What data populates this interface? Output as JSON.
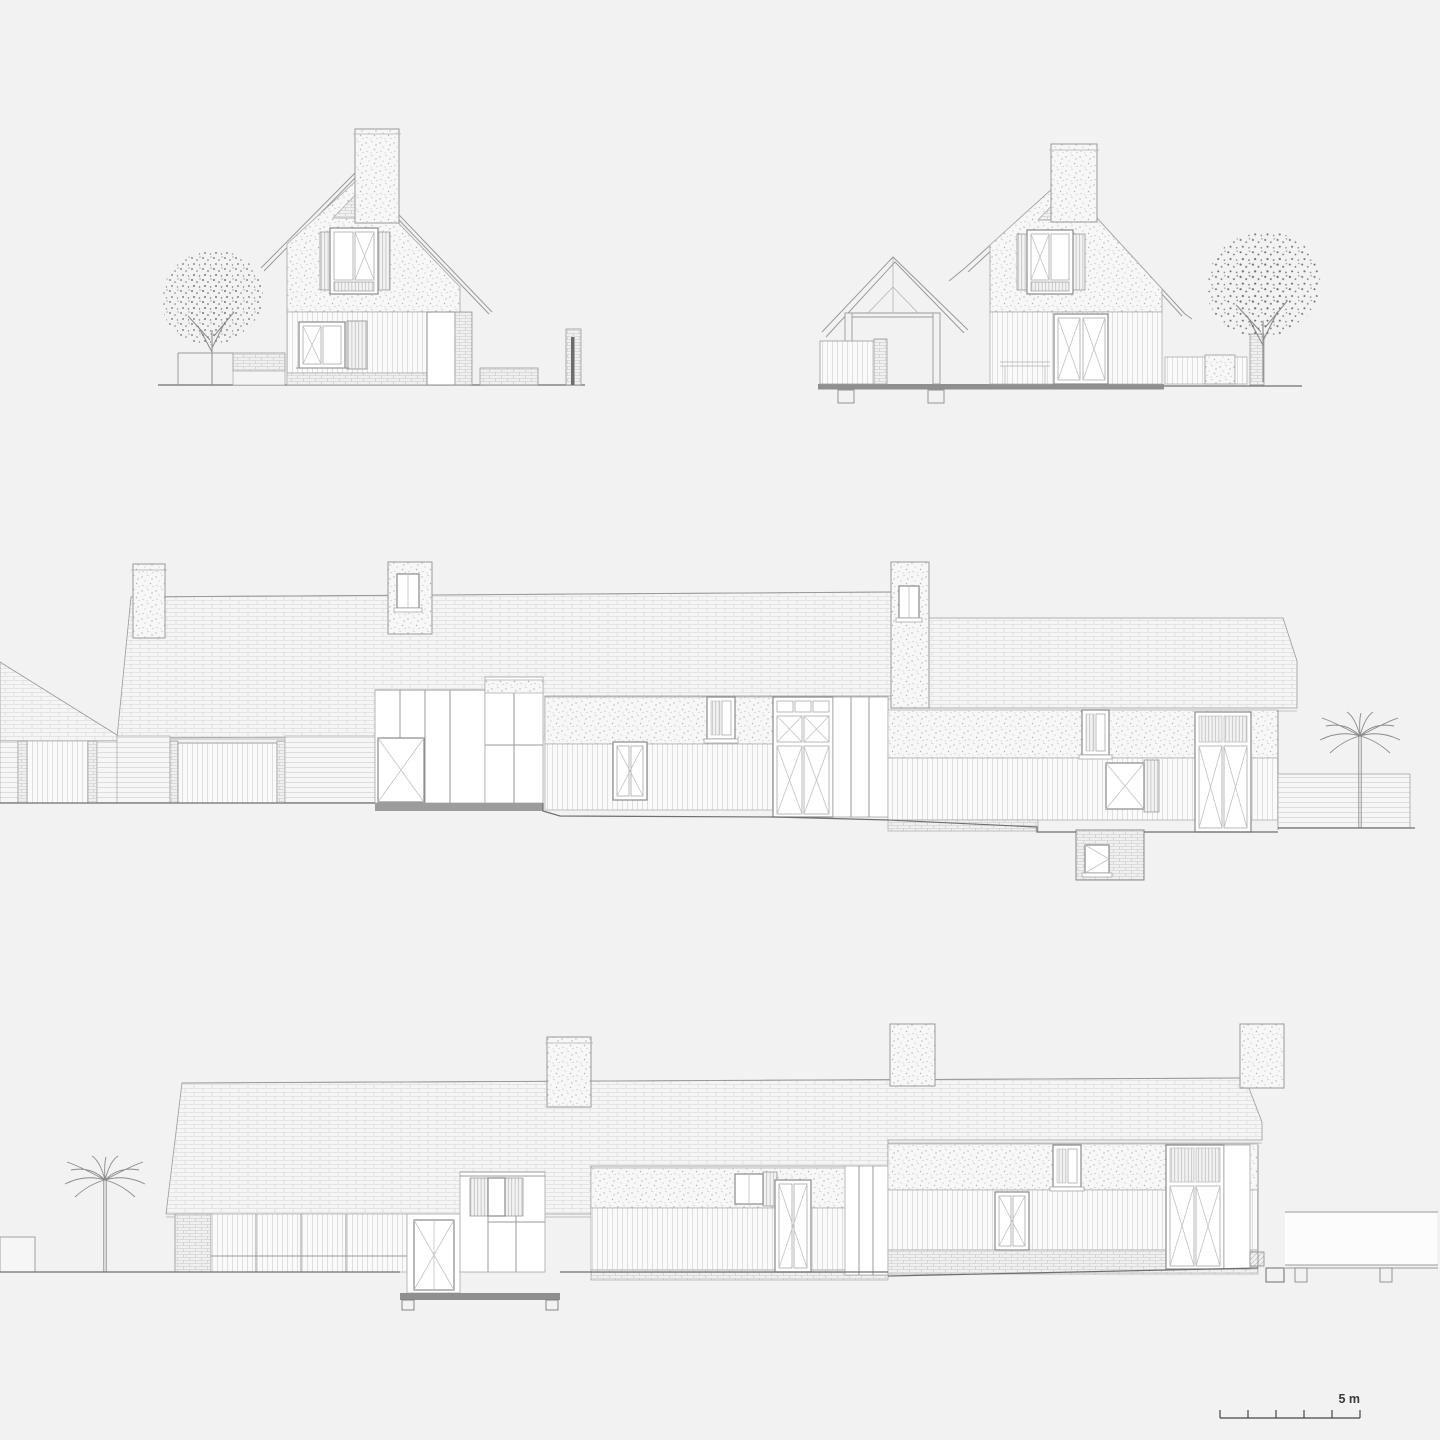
{
  "page": {
    "background_color": "#f2f2f2"
  },
  "drawing": {
    "line_color": "#9a9a9a",
    "dark_line_color": "#5f5f5f",
    "section_fill_color": "#8f8f8f",
    "plinth_color": "#9c9c9c",
    "rows": [
      {
        "id": "elevation-top-left",
        "content": "gable end elevation with chimney, shuttered windows, tree, garden bench and gate pier"
      },
      {
        "id": "elevation-top-right",
        "content": "gable end elevation with open timber porch truss, barn doors, tree and garden fence"
      },
      {
        "id": "elevation-middle",
        "content": "long side elevation with low wing, roof chimneys, glazed link, basement window and palm tree"
      },
      {
        "id": "elevation-bottom",
        "content": "long side elevation with glazed bays, entrance, roof chimneys, deck wall and palm tree"
      }
    ]
  },
  "scale_bar": {
    "label": "5 m",
    "segments": 5
  },
  "icons": {
    "deciduous_tree": "deciduous-tree-icon",
    "palm_tree": "palm-tree-icon"
  }
}
